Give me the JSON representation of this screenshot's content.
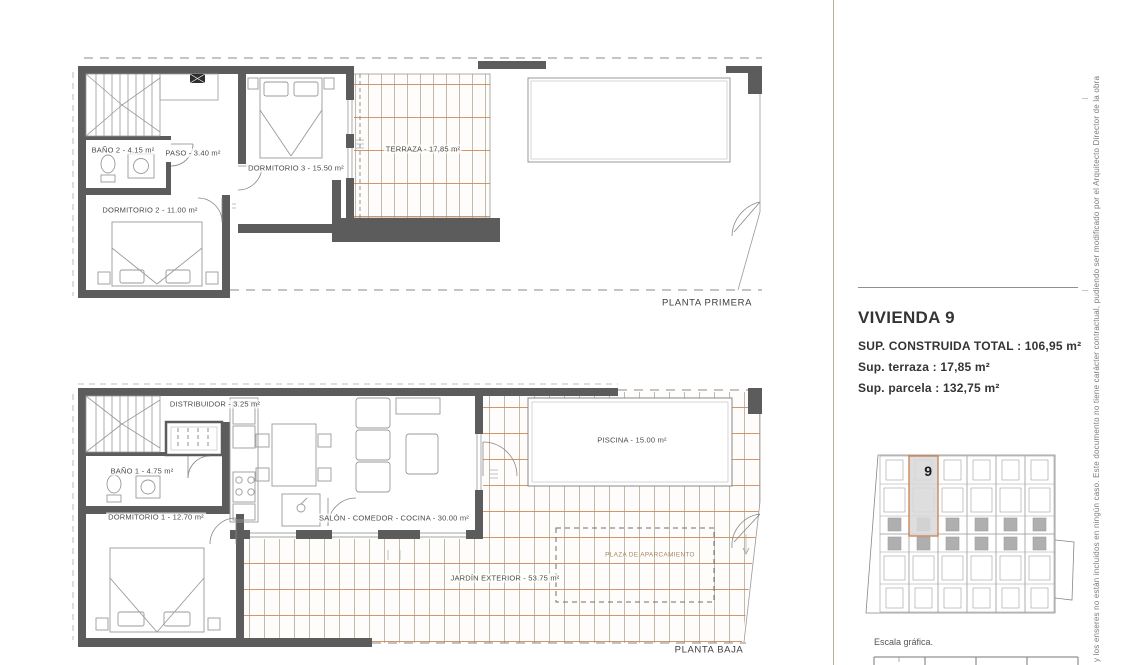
{
  "colors": {
    "wall_gray": "#5c5c5c",
    "tile_orange": "#c98553",
    "tile_tan": "#b6a998",
    "accent_orange": "#c97f4e",
    "highlight_gray": "#d8d8d8"
  },
  "plans": {
    "first": {
      "title": "PLANTA PRIMERA",
      "rooms": {
        "bano2": "BAÑO 2 - 4.15 m²",
        "paso": "PASO - 3.40 m²",
        "dorm3": "DORMITORIO 3 - 15.50 m²",
        "dorm2": "DORMITORIO 2 - 11.00 m²",
        "terraza": "TERRAZA - 17,85 m²"
      }
    },
    "ground": {
      "title": "PLANTA BAJA",
      "rooms": {
        "distribuidor": "DISTRIBUIDOR - 3.25 m²",
        "bano1": "BAÑO 1 - 4.75 m²",
        "dorm1": "DORMITORIO 1 - 12.70 m²",
        "salon": "SALÓN - COMEDOR - COCINA - 30.00 m²",
        "piscina": "PISCINA - 15.00 m²",
        "jardin": "JARDÍN EXTERIOR - 53.75 m²",
        "plaza": "PLAZA DE APARCAMIENTO"
      }
    }
  },
  "summary": {
    "title": "VIVIENDA 9",
    "built_total": "SUP. CONSTRUIDA TOTAL : 106,95 m²",
    "terrace": "Sup. terraza : 17,85 m²",
    "plot": "Sup. parcela : 132,75 m²"
  },
  "site_plan": {
    "unit_number": "9"
  },
  "scale_label": "Escala gráfica.",
  "disclaimer": "y los enseres no están incluidos en ningún caso. Este documento no tiene carácter contractual, pudiendo ser modificado por el Arquitecto Director de la obra"
}
